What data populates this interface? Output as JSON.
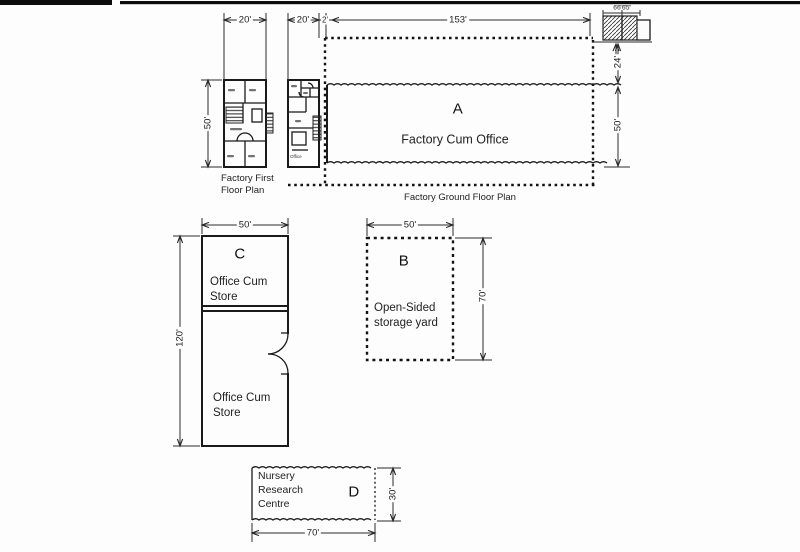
{
  "drawing": {
    "first_floor": {
      "width_dim": "20'",
      "height_dim": "50'",
      "caption": "Factory First\nFloor Plan"
    },
    "ground_floor_unit": {
      "width_dim": "20'",
      "office_label": "Office"
    },
    "boundary_gap_dim": "2'",
    "building_a": {
      "letter": "A",
      "name": "Factory Cum Office",
      "caption": "Factory Ground Floor Plan",
      "length_dim": "153'",
      "front_depth_dim": "24'",
      "depth_dim": "50'",
      "toilet_detail_dim": "6'6\"6'5\""
    },
    "building_b": {
      "letter": "B",
      "name": "Open-Sided\nstorage yard",
      "width_dim": "50'",
      "height_dim": "70'"
    },
    "building_c": {
      "letter": "C",
      "upper_room": "Office Cum\nStore",
      "lower_room": "Office Cum\nStore",
      "width_dim": "50'",
      "height_dim": "120'"
    },
    "building_d": {
      "letter": "D",
      "name": "Nursery\nResearch\nCentre",
      "width_dim": "70'",
      "height_dim": "30'"
    }
  }
}
